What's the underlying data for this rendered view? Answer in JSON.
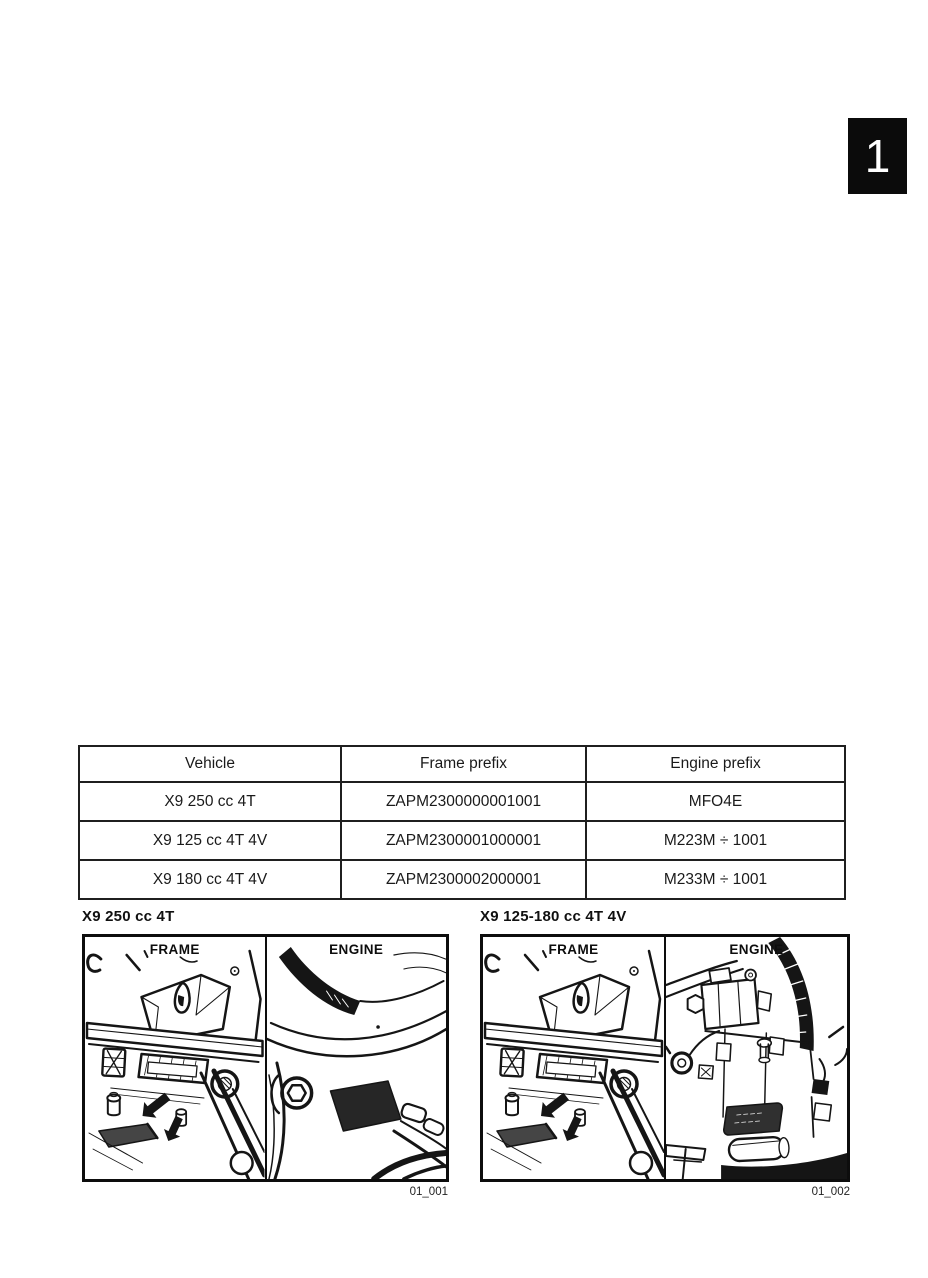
{
  "page": {
    "tab_number": "1"
  },
  "table": {
    "headers": [
      "Vehicle",
      "Frame prefix",
      "Engine prefix"
    ],
    "rows": [
      [
        "X9 250 cc 4T",
        "ZAPM2300000001001",
        "MFO4E"
      ],
      [
        "X9 125 cc 4T 4V",
        "ZAPM2300001000001",
        "M223M ÷ 1001"
      ],
      [
        "X9 180 cc 4T 4V",
        "ZAPM2300002000001",
        "M233M ÷ 1001"
      ]
    ]
  },
  "figures": [
    {
      "title": "X9 250 cc 4T",
      "panels": [
        {
          "label": "FRAME"
        },
        {
          "label": "ENGINE"
        }
      ],
      "caption": "01_001"
    },
    {
      "title": "X9 125-180 cc 4T 4V",
      "panels": [
        {
          "label": "FRAME"
        },
        {
          "label": "ENGINE"
        }
      ],
      "caption": "01_002"
    }
  ],
  "colors": {
    "ink": "#151515",
    "tab_bg": "#0b0b0b",
    "plate_dark": "#303030"
  }
}
